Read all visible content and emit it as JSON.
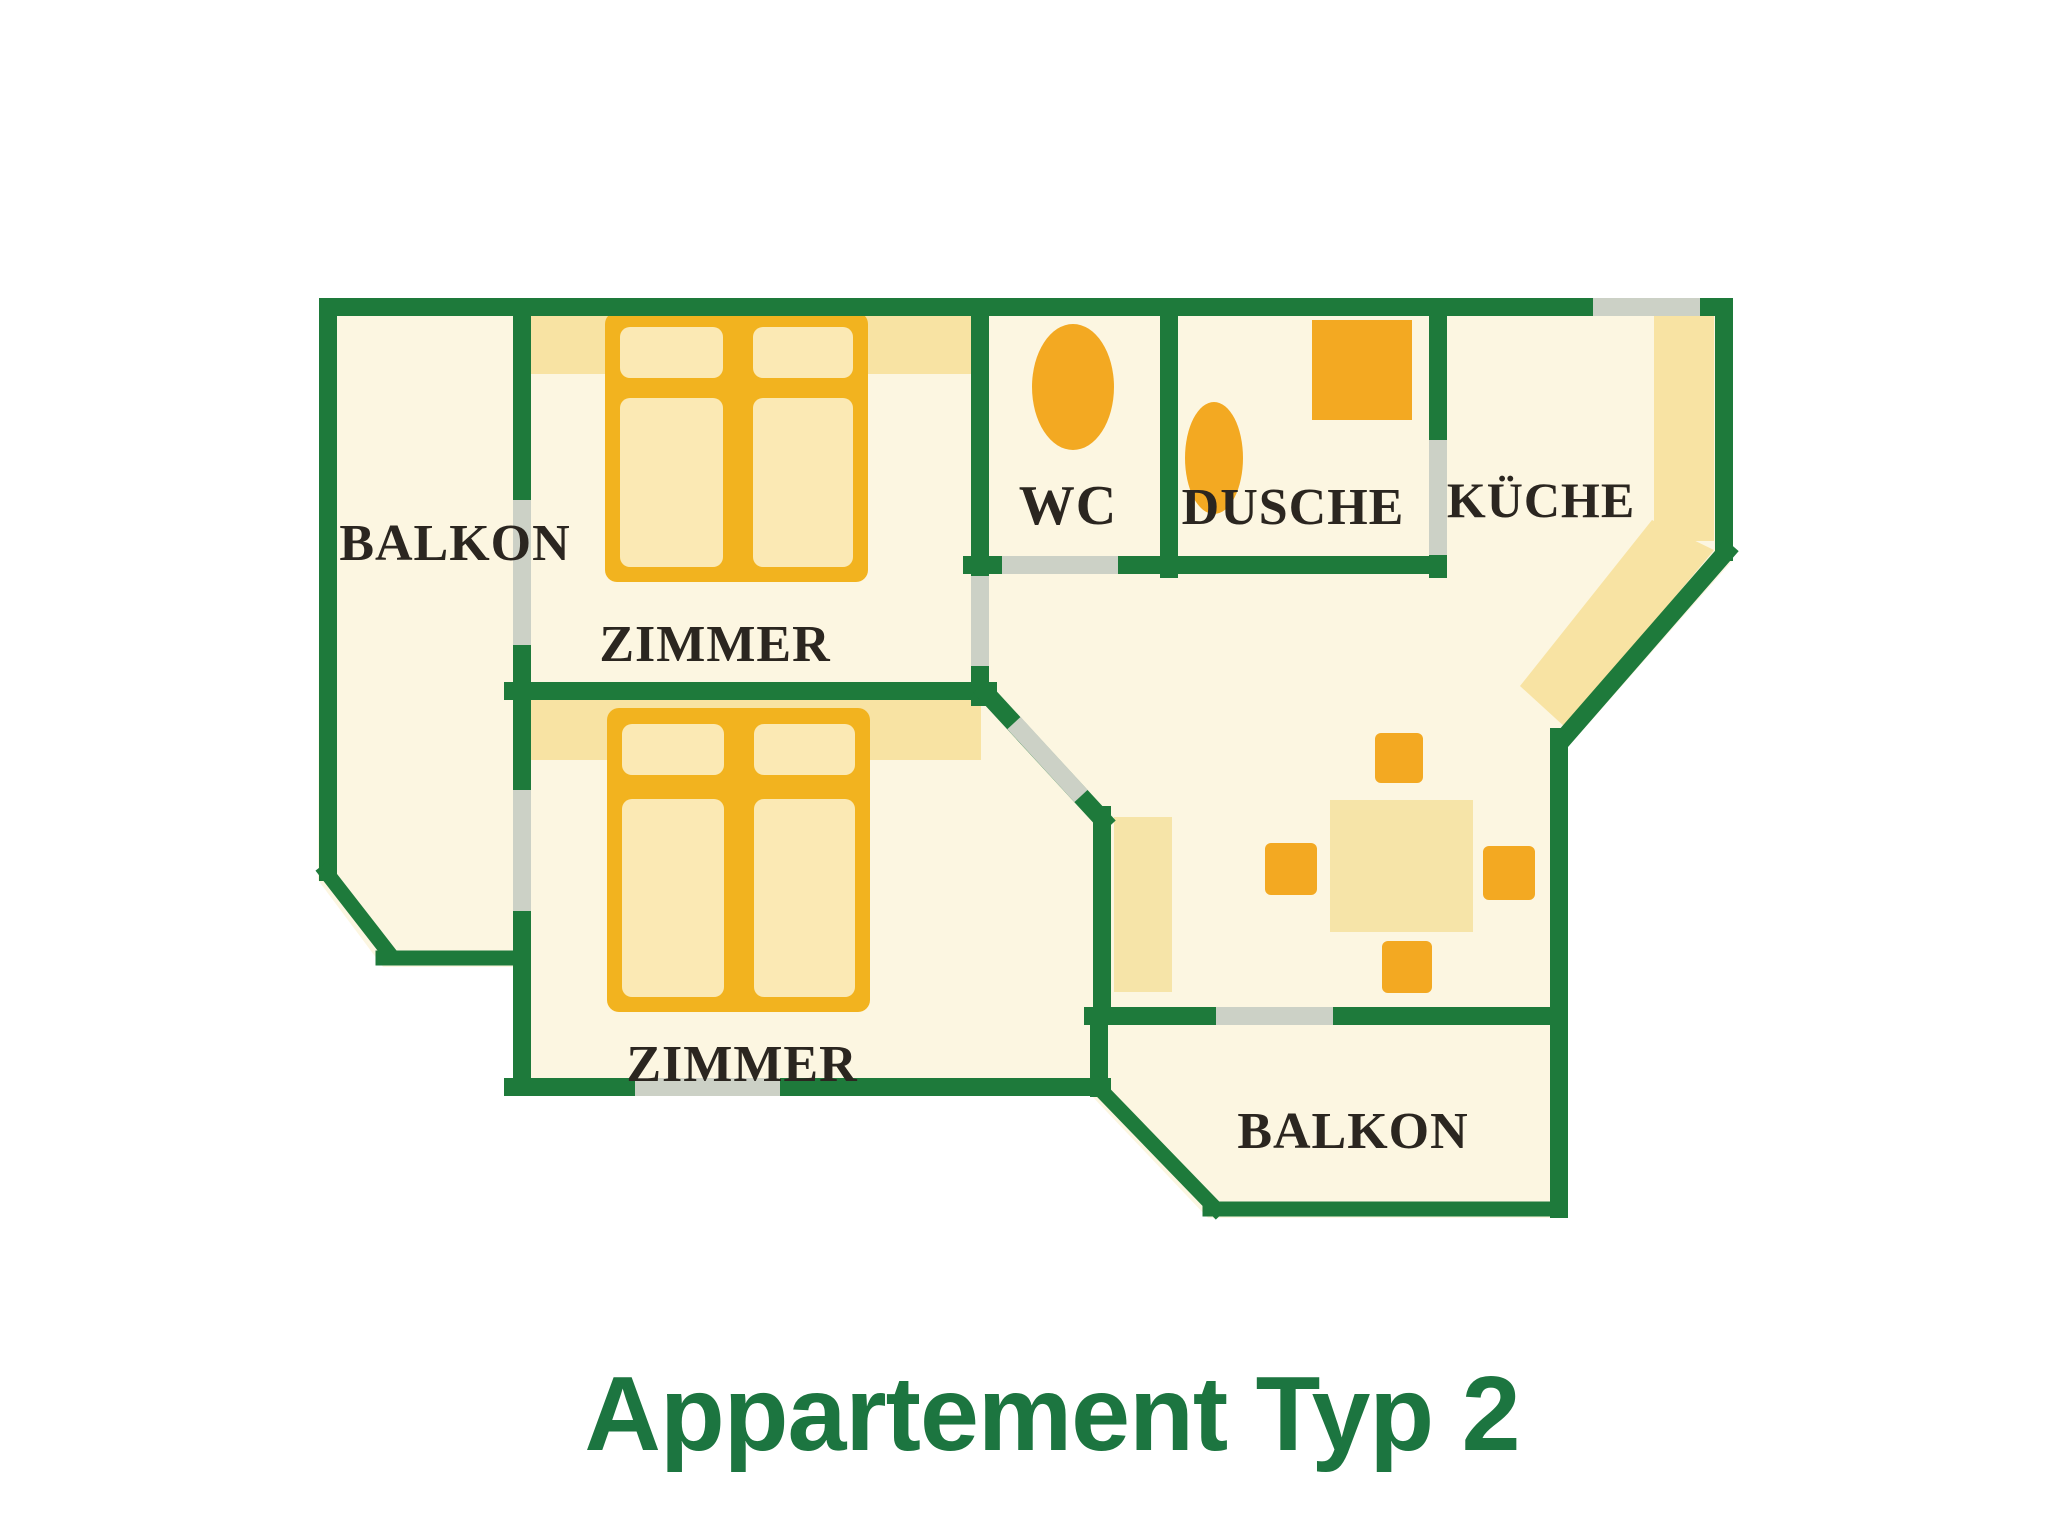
{
  "title": "Appartement Typ 2",
  "rooms": {
    "balkon_top": "BALKON",
    "zimmer_top": "ZIMMER",
    "wc": "WC",
    "dusche": "DUSCHE",
    "kueche": "KÜCHE",
    "zimmer_bottom": "ZIMMER",
    "balkon_bottom": "BALKON"
  },
  "furniture": {
    "beds": 2,
    "toilet": "wc-toilet",
    "shower_sink": "dusche-sink",
    "shower_tray": "dusche-shower-tray",
    "kitchen_counter": "kueche-counter",
    "dining_chairs": 4
  },
  "colors": {
    "wall": "#1E7A3B",
    "opening": "#CCD1C6",
    "floor": "#FCF6E1",
    "band": "#F8E3A3",
    "furniture": "#F3A922",
    "bed_frame": "#F2B31F",
    "bed_fill": "#FBE9B4",
    "table": "#F6E4A8",
    "label": "#2B2620",
    "title": "#1C7540"
  }
}
